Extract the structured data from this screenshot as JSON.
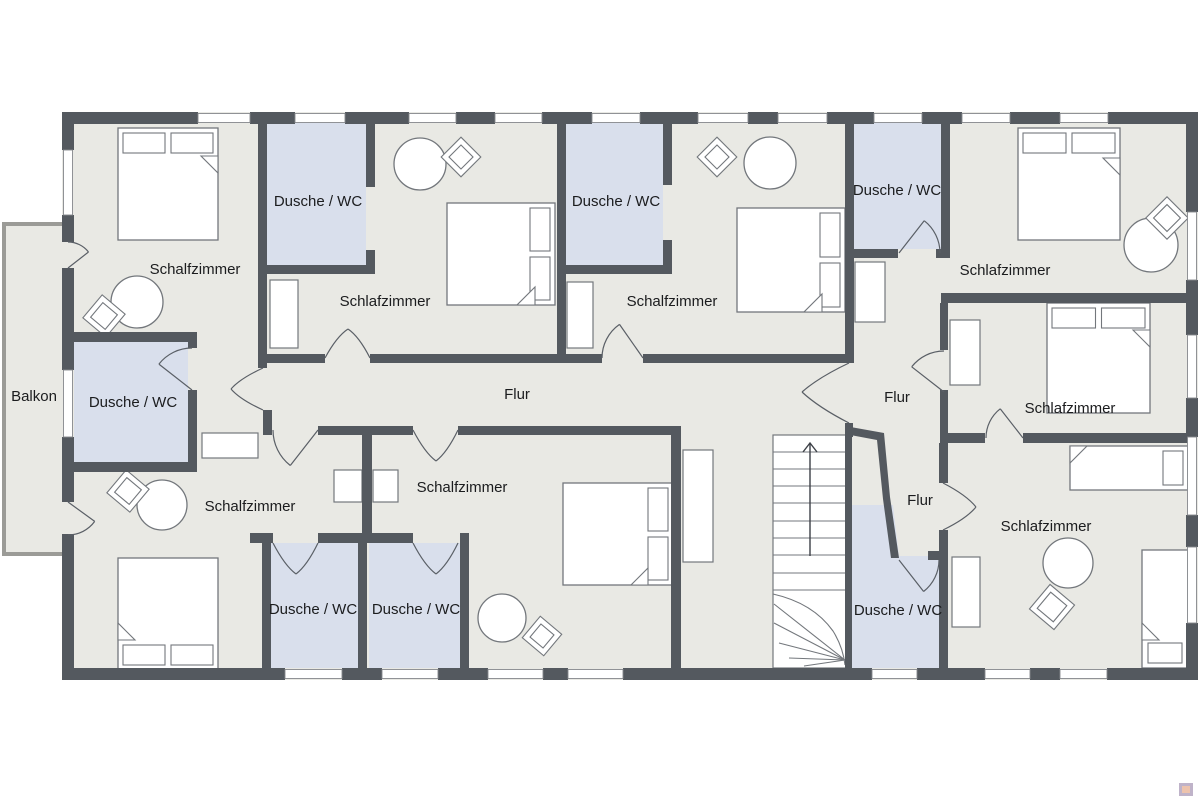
{
  "floorplan": {
    "colors": {
      "wall": "#54595f",
      "floor": "#e9e9e4",
      "wet_room": "#d9dfec",
      "furniture_outline": "#73777c",
      "door_stroke": "#5a5f66",
      "window_frame": "#85888c",
      "balcony_wall": "#9b9b97",
      "text": "#1b1c1e",
      "white": "#ffffff"
    },
    "labels": [
      {
        "text": "Schalfzimmer",
        "x": 195,
        "y": 269
      },
      {
        "text": "Dusche / WC",
        "x": 318,
        "y": 201
      },
      {
        "text": "Schlafzimmer",
        "x": 385,
        "y": 301
      },
      {
        "text": "Dusche / WC",
        "x": 616,
        "y": 201
      },
      {
        "text": "Schalfzimmer",
        "x": 672,
        "y": 301
      },
      {
        "text": "Dusche / WC",
        "x": 897,
        "y": 190
      },
      {
        "text": "Schlafzimmer",
        "x": 1005,
        "y": 270
      },
      {
        "text": "Schlafzimmer",
        "x": 1070,
        "y": 408
      },
      {
        "text": "Flur",
        "x": 517,
        "y": 394
      },
      {
        "text": "Flur",
        "x": 897,
        "y": 397
      },
      {
        "text": "Flur",
        "x": 920,
        "y": 500
      },
      {
        "text": "Balkon",
        "x": 34,
        "y": 396
      },
      {
        "text": "Dusche / WC",
        "x": 133,
        "y": 402
      },
      {
        "text": "Schalfzimmer",
        "x": 250,
        "y": 506
      },
      {
        "text": "Schalfzimmer",
        "x": 462,
        "y": 487
      },
      {
        "text": "Dusche / WC",
        "x": 313,
        "y": 609
      },
      {
        "text": "Dusche / WC",
        "x": 416,
        "y": 609
      },
      {
        "text": "Dusche / WC",
        "x": 898,
        "y": 610
      },
      {
        "text": "Schlafzimmer",
        "x": 1046,
        "y": 526
      }
    ],
    "floor": {
      "x": 62,
      "y": 112,
      "w": 1136,
      "h": 568
    },
    "balcony": {
      "floor": [
        2,
        222,
        60,
        332
      ],
      "walls": [
        [
          2,
          222,
          62,
          4
        ],
        [
          2,
          552,
          62,
          4
        ],
        [
          2,
          222,
          4,
          334
        ]
      ]
    },
    "wet_rooms": [
      {
        "rect": [
          267,
          121,
          99,
          144
        ]
      },
      {
        "rect": [
          566,
          121,
          97,
          144
        ]
      },
      {
        "rect": [
          853,
          121,
          88,
          128
        ]
      },
      {
        "rect": [
          74,
          342,
          114,
          120
        ]
      },
      {
        "rect": [
          271,
          543,
          87,
          125
        ]
      },
      {
        "rect": [
          369,
          543,
          91,
          125
        ]
      },
      {
        "poly": "M852,668 L939,668 L939,556 L899,556 L893,505 L852,505 Z"
      }
    ],
    "outer_walls": [
      [
        62,
        112,
        136,
        12
      ],
      [
        250,
        112,
        45,
        12
      ],
      [
        345,
        112,
        64,
        12
      ],
      [
        456,
        112,
        39,
        12
      ],
      [
        542,
        112,
        50,
        12
      ],
      [
        640,
        112,
        58,
        12
      ],
      [
        748,
        112,
        30,
        12
      ],
      [
        827,
        112,
        47,
        12
      ],
      [
        922,
        112,
        40,
        12
      ],
      [
        1010,
        112,
        50,
        12
      ],
      [
        1108,
        112,
        90,
        12
      ],
      [
        62,
        668,
        223,
        12
      ],
      [
        342,
        668,
        40,
        12
      ],
      [
        438,
        668,
        50,
        12
      ],
      [
        543,
        668,
        25,
        12
      ],
      [
        623,
        668,
        249,
        12
      ],
      [
        917,
        668,
        68,
        12
      ],
      [
        1030,
        668,
        30,
        12
      ],
      [
        1107,
        668,
        91,
        12
      ],
      [
        62,
        112,
        12,
        38
      ],
      [
        62,
        215,
        12,
        27
      ],
      [
        62,
        268,
        12,
        102
      ],
      [
        62,
        437,
        12,
        65
      ],
      [
        62,
        534,
        12,
        134
      ],
      [
        1186,
        112,
        12,
        100
      ],
      [
        1186,
        280,
        12,
        55
      ],
      [
        1186,
        398,
        12,
        39
      ],
      [
        1186,
        515,
        12,
        32
      ],
      [
        1186,
        623,
        12,
        57
      ]
    ],
    "inner_walls": [
      [
        258,
        112,
        9,
        256
      ],
      [
        366,
        112,
        9,
        75
      ],
      [
        366,
        250,
        9,
        24
      ],
      [
        258,
        265,
        117,
        9
      ],
      [
        557,
        112,
        9,
        251
      ],
      [
        663,
        112,
        9,
        73
      ],
      [
        663,
        240,
        9,
        34
      ],
      [
        557,
        265,
        115,
        9
      ],
      [
        845,
        112,
        9,
        251
      ],
      [
        845,
        249,
        53,
        9
      ],
      [
        936,
        249,
        14,
        9
      ],
      [
        941,
        112,
        9,
        146
      ],
      [
        941,
        293,
        247,
        10
      ],
      [
        940,
        303,
        8,
        47
      ],
      [
        940,
        390,
        8,
        43
      ],
      [
        940,
        433,
        45,
        10
      ],
      [
        1023,
        433,
        165,
        10
      ],
      [
        939,
        443,
        9,
        40
      ],
      [
        939,
        530,
        9,
        138
      ],
      [
        267,
        354,
        58,
        9
      ],
      [
        370,
        354,
        187,
        9
      ],
      [
        566,
        354,
        36,
        9
      ],
      [
        643,
        354,
        204,
        9
      ],
      [
        263,
        410,
        9,
        25
      ],
      [
        318,
        426,
        95,
        9
      ],
      [
        458,
        426,
        213,
        9
      ],
      [
        671,
        426,
        10,
        246
      ],
      [
        62,
        332,
        135,
        10
      ],
      [
        188,
        332,
        9,
        16
      ],
      [
        188,
        390,
        9,
        82
      ],
      [
        62,
        462,
        135,
        10
      ],
      [
        250,
        533,
        23,
        10
      ],
      [
        318,
        533,
        95,
        10
      ],
      [
        262,
        533,
        9,
        135
      ],
      [
        358,
        533,
        9,
        135
      ],
      [
        460,
        533,
        9,
        135
      ],
      [
        362,
        426,
        10,
        117
      ],
      [
        845,
        423,
        8,
        14
      ],
      [
        928,
        551,
        11,
        9
      ],
      [
        845,
        434,
        7,
        234
      ]
    ],
    "diagonal_walls": [
      "M845,426 L884,433 L890,497 L899,558 L891,558 L883,499 L877,440 L845,434 Z"
    ],
    "windows": [
      [
        198,
        113.5,
        52,
        9
      ],
      [
        295,
        113.5,
        50,
        9
      ],
      [
        409,
        113.5,
        47,
        9
      ],
      [
        495,
        113.5,
        47,
        9
      ],
      [
        592,
        113.5,
        48,
        9
      ],
      [
        698,
        113.5,
        50,
        9
      ],
      [
        778,
        113.5,
        49,
        9
      ],
      [
        874,
        113.5,
        48,
        9
      ],
      [
        962,
        113.5,
        48,
        9
      ],
      [
        1060,
        113.5,
        48,
        9
      ],
      [
        285,
        669.5,
        57,
        9
      ],
      [
        382,
        669.5,
        56,
        9
      ],
      [
        488,
        669.5,
        55,
        9
      ],
      [
        568,
        669.5,
        55,
        9
      ],
      [
        872,
        669.5,
        45,
        9
      ],
      [
        985,
        669.5,
        45,
        9
      ],
      [
        1060,
        669.5,
        47,
        9
      ],
      [
        63.5,
        150,
        9,
        65
      ],
      [
        63.5,
        370,
        9,
        67
      ],
      [
        1187.5,
        212,
        9,
        68
      ],
      [
        1187.5,
        335,
        9,
        63
      ],
      [
        1187.5,
        437,
        9,
        78
      ],
      [
        1187.5,
        547,
        9,
        76
      ]
    ],
    "doors_single": [
      {
        "h": [
          68,
          268
        ],
        "r": 26,
        "a0": -90,
        "a1": -38
      },
      {
        "h": [
          68,
          502
        ],
        "r": 33,
        "a0": 90,
        "a1": 36
      },
      {
        "h": [
          192,
          390
        ],
        "r": 42,
        "a0": -90,
        "a1": -142
      },
      {
        "h": [
          643,
          358
        ],
        "r": 41,
        "a0": 180,
        "a1": 235
      },
      {
        "h": [
          899,
          253
        ],
        "r": 41,
        "a0": 0,
        "a1": -52
      },
      {
        "h": [
          944,
          392
        ],
        "r": 41,
        "a0": -90,
        "a1": -142
      },
      {
        "h": [
          1023,
          438
        ],
        "r": 37,
        "a0": 180,
        "a1": 232
      },
      {
        "h": [
          318,
          430
        ],
        "r": 45,
        "a0": 180,
        "a1": 128
      },
      {
        "h": [
          899,
          560
        ],
        "r": 40,
        "a0": 0,
        "a1": 52
      }
    ],
    "doors_double": [
      {
        "j1": [
          263,
          368
        ],
        "j2": [
          263,
          410
        ],
        "apex": [
          231,
          389
        ]
      },
      {
        "j1": [
          325,
          358
        ],
        "j2": [
          370,
          358
        ],
        "apex": [
          348,
          329
        ]
      },
      {
        "j1": [
          849,
          363
        ],
        "j2": [
          849,
          423
        ],
        "apex": [
          802,
          392
        ]
      },
      {
        "j1": [
          943,
          483
        ],
        "j2": [
          943,
          530
        ],
        "apex": [
          976,
          507
        ]
      },
      {
        "j1": [
          413,
          430
        ],
        "j2": [
          458,
          430
        ],
        "apex": [
          436,
          461
        ]
      },
      {
        "j1": [
          273,
          543
        ],
        "j2": [
          318,
          543
        ],
        "apex": [
          296,
          574
        ]
      },
      {
        "j1": [
          413,
          543
        ],
        "j2": [
          458,
          543
        ],
        "apex": [
          436,
          574
        ]
      }
    ],
    "beds": [
      {
        "r": [
          118,
          128,
          100,
          112
        ],
        "side": "top",
        "n": 2,
        "flap": [
          [
            218,
            156
          ],
          [
            201,
            156
          ],
          [
            218,
            173
          ]
        ]
      },
      {
        "r": [
          447,
          203,
          108,
          102
        ],
        "side": "right",
        "n": 2,
        "flap": [
          [
            535,
            305
          ],
          [
            517,
            305
          ],
          [
            535,
            287
          ]
        ]
      },
      {
        "r": [
          737,
          208,
          108,
          104
        ],
        "side": "right",
        "n": 2,
        "flap": [
          [
            822,
            312
          ],
          [
            804,
            312
          ],
          [
            822,
            294
          ]
        ]
      },
      {
        "r": [
          1018,
          128,
          102,
          112
        ],
        "side": "top",
        "n": 2,
        "flap": [
          [
            1120,
            158
          ],
          [
            1103,
            158
          ],
          [
            1120,
            175
          ]
        ]
      },
      {
        "r": [
          1047,
          303,
          103,
          110
        ],
        "side": "top",
        "n": 2,
        "flap": [
          [
            1150,
            330
          ],
          [
            1133,
            330
          ],
          [
            1150,
            347
          ]
        ]
      },
      {
        "r": [
          1070,
          446,
          118,
          44
        ],
        "side": "right",
        "n": 1,
        "flap": [
          [
            1070,
            446
          ],
          [
            1087,
            446
          ],
          [
            1070,
            463
          ]
        ]
      },
      {
        "r": [
          1142,
          550,
          46,
          118
        ],
        "side": "bottom",
        "n": 1,
        "flap": [
          [
            1142,
            640
          ],
          [
            1159,
            640
          ],
          [
            1142,
            623
          ]
        ]
      },
      {
        "r": [
          118,
          558,
          100,
          112
        ],
        "side": "bottom",
        "n": 2,
        "flap": [
          [
            118,
            640
          ],
          [
            135,
            640
          ],
          [
            118,
            623
          ]
        ]
      },
      {
        "r": [
          563,
          483,
          110,
          102
        ],
        "side": "right",
        "n": 2,
        "flap": [
          [
            648,
            585
          ],
          [
            631,
            585
          ],
          [
            648,
            568
          ]
        ]
      }
    ],
    "tables": [
      [
        137,
        302,
        26
      ],
      [
        420,
        164,
        26
      ],
      [
        770,
        163,
        26
      ],
      [
        1151,
        245,
        27
      ],
      [
        1068,
        563,
        25
      ],
      [
        162,
        505,
        25
      ],
      [
        502,
        618,
        24
      ]
    ],
    "chairs": [
      [
        104,
        316,
        30,
        40
      ],
      [
        461,
        157,
        28,
        45
      ],
      [
        717,
        157,
        28,
        45
      ],
      [
        1167,
        218,
        30,
        45
      ],
      [
        1052,
        607,
        32,
        40
      ],
      [
        128,
        491,
        30,
        40
      ],
      [
        542,
        636,
        28,
        40
      ]
    ],
    "cabinets": [
      [
        270,
        280,
        28,
        68
      ],
      [
        567,
        282,
        26,
        66
      ],
      [
        855,
        262,
        30,
        60
      ],
      [
        950,
        320,
        30,
        65
      ],
      [
        952,
        557,
        28,
        70
      ],
      [
        683,
        450,
        30,
        112
      ],
      [
        202,
        433,
        56,
        25
      ],
      [
        334,
        470,
        28,
        32
      ],
      [
        373,
        470,
        25,
        32
      ]
    ],
    "stairs": {
      "box": [
        773,
        435,
        74,
        233
      ],
      "treads_y": [
        452,
        469,
        486,
        503,
        521,
        538,
        555,
        573,
        590
      ],
      "curve": "M773,594 Q813,603 833,631 Q843,647 845,665",
      "fan": [
        [
          845,
          660,
          774,
          604
        ],
        [
          845,
          660,
          774,
          623
        ],
        [
          845,
          660,
          779,
          643
        ],
        [
          845,
          660,
          789,
          658
        ],
        [
          845,
          660,
          804,
          666
        ]
      ],
      "arrow_line": [
        810,
        556,
        810,
        444
      ],
      "arrow_head": "M803,452 L810,443 L817,452"
    },
    "watermark": {
      "outer": [
        1179,
        783,
        14,
        13
      ],
      "outer_color": "#bfb3c9",
      "inner": [
        1182,
        786,
        8,
        7
      ],
      "inner_color": "#edc3ad"
    }
  }
}
